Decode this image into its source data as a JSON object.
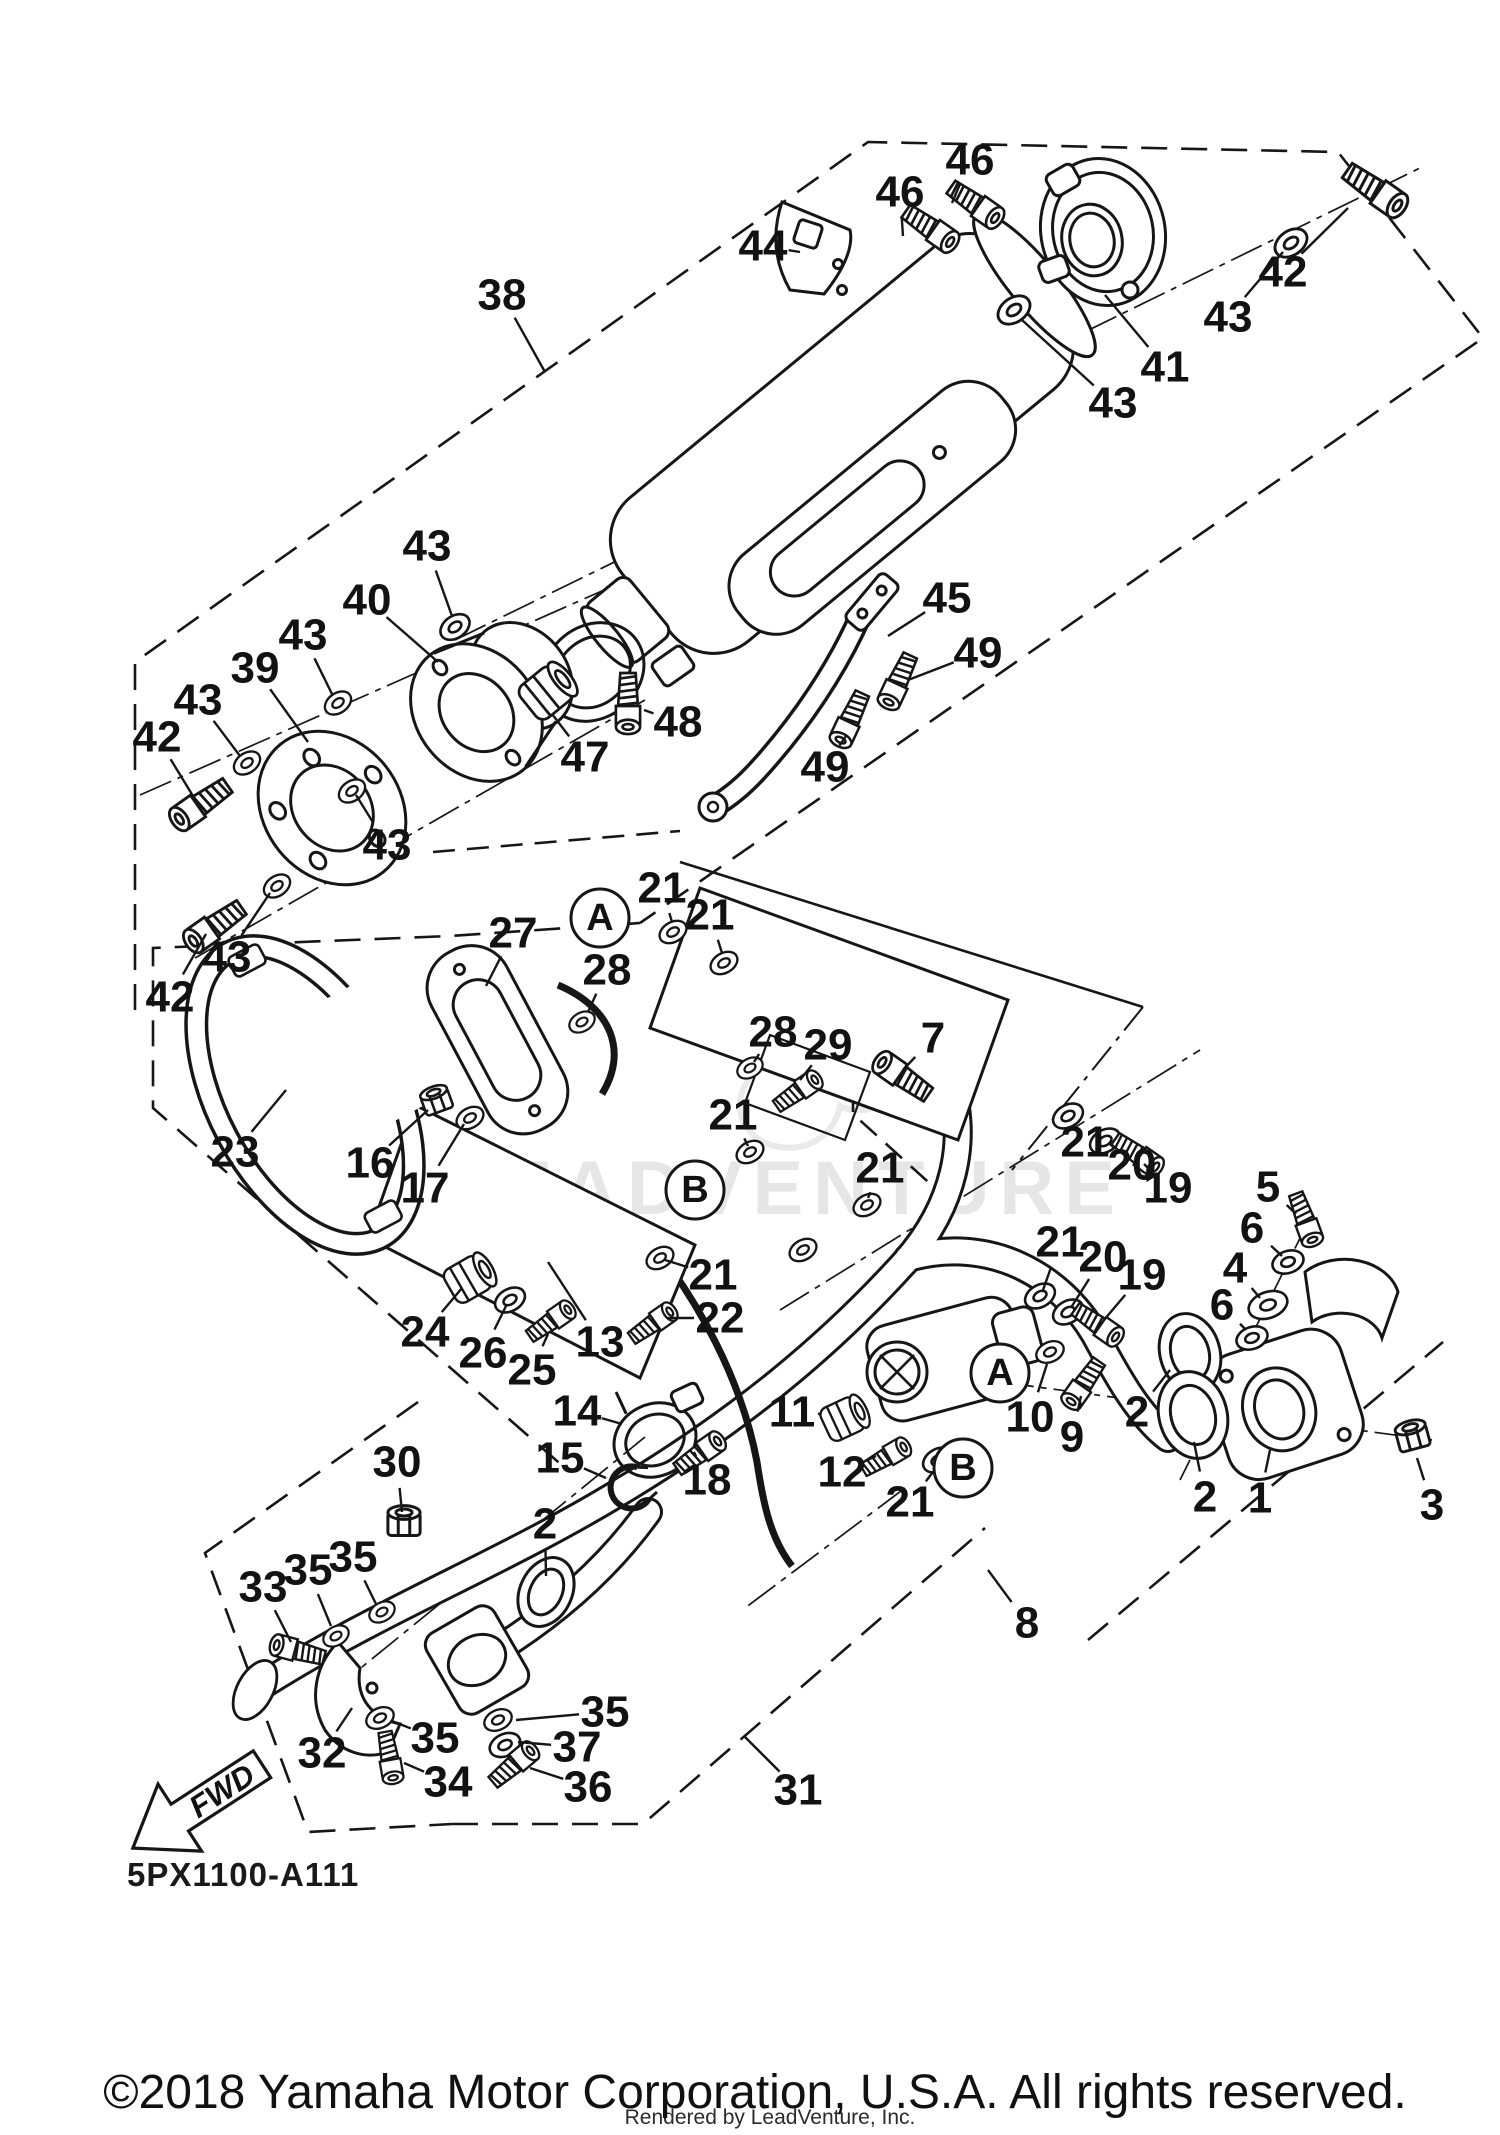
{
  "diagram": {
    "code": "5PX1100-A111",
    "watermark": "LEADVENTURE",
    "fwd_label": "FWD",
    "connectors": [
      {
        "label": "A",
        "x": 600,
        "y": 918
      },
      {
        "label": "B",
        "x": 695,
        "y": 1190
      },
      {
        "label": "A",
        "x": 1000,
        "y": 1373
      },
      {
        "label": "B",
        "x": 963,
        "y": 1468
      }
    ],
    "callouts": [
      {
        "label": "46",
        "x": 970,
        "y": 160,
        "lx": 952,
        "ly": 203
      },
      {
        "label": "46",
        "x": 900,
        "y": 192,
        "lx": 903,
        "ly": 236
      },
      {
        "label": "44",
        "x": 763,
        "y": 246,
        "lx": 800,
        "ly": 252
      },
      {
        "label": "38",
        "x": 502,
        "y": 295,
        "lx": 545,
        "ly": 372
      },
      {
        "label": "42",
        "x": 1283,
        "y": 272,
        "lx": 1348,
        "ly": 208
      },
      {
        "label": "43",
        "x": 1228,
        "y": 317,
        "lx": 1283,
        "ly": 252
      },
      {
        "label": "41",
        "x": 1165,
        "y": 367,
        "lx": 1105,
        "ly": 295
      },
      {
        "label": "43",
        "x": 1113,
        "y": 403,
        "lx": 1022,
        "ly": 320
      },
      {
        "label": "43",
        "x": 427,
        "y": 546,
        "lx": 452,
        "ly": 616
      },
      {
        "label": "40",
        "x": 367,
        "y": 600,
        "lx": 438,
        "ly": 662
      },
      {
        "label": "43",
        "x": 303,
        "y": 635,
        "lx": 332,
        "ly": 694
      },
      {
        "label": "39",
        "x": 255,
        "y": 668,
        "lx": 308,
        "ly": 742
      },
      {
        "label": "43",
        "x": 198,
        "y": 700,
        "lx": 240,
        "ly": 756
      },
      {
        "label": "42",
        "x": 157,
        "y": 737,
        "lx": 193,
        "ly": 796
      },
      {
        "label": "43",
        "x": 387,
        "y": 845,
        "lx": 356,
        "ly": 795
      },
      {
        "label": "43",
        "x": 227,
        "y": 957,
        "lx": 270,
        "ly": 893
      },
      {
        "label": "42",
        "x": 170,
        "y": 997,
        "lx": 206,
        "ly": 934
      },
      {
        "label": "45",
        "x": 947,
        "y": 598,
        "lx": 888,
        "ly": 636
      },
      {
        "label": "49",
        "x": 978,
        "y": 653,
        "lx": 908,
        "ly": 680
      },
      {
        "label": "48",
        "x": 678,
        "y": 722,
        "lx": 644,
        "ly": 710
      },
      {
        "label": "47",
        "x": 585,
        "y": 757,
        "lx": 552,
        "ly": 714
      },
      {
        "label": "49",
        "x": 825,
        "y": 767,
        "lx": 846,
        "ly": 736
      },
      {
        "label": "27",
        "x": 513,
        "y": 933,
        "lx": 486,
        "ly": 986
      },
      {
        "label": "21",
        "x": 662,
        "y": 888,
        "lx": 672,
        "ly": 922
      },
      {
        "label": "21",
        "x": 710,
        "y": 915,
        "lx": 722,
        "ly": 953
      },
      {
        "label": "28",
        "x": 607,
        "y": 970,
        "lx": 588,
        "ly": 1012
      },
      {
        "label": "28",
        "x": 773,
        "y": 1032,
        "lx": 754,
        "ly": 1062
      },
      {
        "label": "29",
        "x": 828,
        "y": 1045,
        "lx": 800,
        "ly": 1080
      },
      {
        "label": "7",
        "x": 933,
        "y": 1038,
        "lx": 903,
        "ly": 1070
      },
      {
        "label": "23",
        "x": 235,
        "y": 1152,
        "lx": 286,
        "ly": 1090
      },
      {
        "label": "16",
        "x": 370,
        "y": 1163,
        "lx": 428,
        "ly": 1110
      },
      {
        "label": "17",
        "x": 425,
        "y": 1188,
        "lx": 464,
        "ly": 1124
      },
      {
        "label": "21",
        "x": 733,
        "y": 1115,
        "lx": 748,
        "ly": 1146
      },
      {
        "label": "21",
        "x": 880,
        "y": 1168,
        "lx": 868,
        "ly": 1198
      },
      {
        "label": "13",
        "x": 600,
        "y": 1342,
        "lx": 548,
        "ly": 1262
      },
      {
        "label": "21",
        "x": 713,
        "y": 1275,
        "lx": 665,
        "ly": 1260
      },
      {
        "label": "22",
        "x": 720,
        "y": 1318,
        "lx": 668,
        "ly": 1318
      },
      {
        "label": "24",
        "x": 425,
        "y": 1332,
        "lx": 462,
        "ly": 1288
      },
      {
        "label": "26",
        "x": 483,
        "y": 1353,
        "lx": 506,
        "ly": 1306
      },
      {
        "label": "25",
        "x": 532,
        "y": 1370,
        "lx": 548,
        "ly": 1334
      },
      {
        "label": "14",
        "x": 577,
        "y": 1411,
        "lx": 622,
        "ly": 1424
      },
      {
        "label": "15",
        "x": 560,
        "y": 1458,
        "lx": 606,
        "ly": 1478
      },
      {
        "label": "18",
        "x": 707,
        "y": 1480,
        "lx": 694,
        "ly": 1452
      },
      {
        "label": "11",
        "x": 792,
        "y": 1412,
        "lx": 820,
        "ly": 1414
      },
      {
        "label": "12",
        "x": 842,
        "y": 1472,
        "lx": 876,
        "ly": 1456
      },
      {
        "label": "21",
        "x": 910,
        "y": 1502,
        "lx": 933,
        "ly": 1472
      },
      {
        "label": "10",
        "x": 1030,
        "y": 1417,
        "lx": 1047,
        "ly": 1364
      },
      {
        "label": "9",
        "x": 1072,
        "y": 1437,
        "lx": 1081,
        "ly": 1396
      },
      {
        "label": "2",
        "x": 1137,
        "y": 1412,
        "lx": 1170,
        "ly": 1370
      },
      {
        "label": "5",
        "x": 1268,
        "y": 1187,
        "lx": 1296,
        "ly": 1214
      },
      {
        "label": "6",
        "x": 1252,
        "y": 1228,
        "lx": 1282,
        "ly": 1256
      },
      {
        "label": "4",
        "x": 1235,
        "y": 1268,
        "lx": 1260,
        "ly": 1298
      },
      {
        "label": "6",
        "x": 1222,
        "y": 1305,
        "lx": 1246,
        "ly": 1330
      },
      {
        "label": "21",
        "x": 1085,
        "y": 1142,
        "lx": 1071,
        "ly": 1121
      },
      {
        "label": "20",
        "x": 1132,
        "y": 1165,
        "lx": 1110,
        "ly": 1144
      },
      {
        "label": "19",
        "x": 1168,
        "y": 1188,
        "lx": 1144,
        "ly": 1164
      },
      {
        "label": "21",
        "x": 1060,
        "y": 1242,
        "lx": 1043,
        "ly": 1290
      },
      {
        "label": "20",
        "x": 1103,
        "y": 1257,
        "lx": 1072,
        "ly": 1306
      },
      {
        "label": "19",
        "x": 1142,
        "y": 1275,
        "lx": 1104,
        "ly": 1320
      },
      {
        "label": "2",
        "x": 1205,
        "y": 1497,
        "lx": 1194,
        "ly": 1442
      },
      {
        "label": "1",
        "x": 1260,
        "y": 1498,
        "lx": 1270,
        "ly": 1450
      },
      {
        "label": "3",
        "x": 1432,
        "y": 1505,
        "lx": 1417,
        "ly": 1458
      },
      {
        "label": "8",
        "x": 1027,
        "y": 1623,
        "lx": 988,
        "ly": 1570
      },
      {
        "label": "30",
        "x": 397,
        "y": 1462,
        "lx": 402,
        "ly": 1512
      },
      {
        "label": "2",
        "x": 545,
        "y": 1524,
        "lx": 546,
        "ly": 1576
      },
      {
        "label": "35",
        "x": 353,
        "y": 1557,
        "lx": 376,
        "ly": 1604
      },
      {
        "label": "35",
        "x": 308,
        "y": 1570,
        "lx": 331,
        "ly": 1626
      },
      {
        "label": "33",
        "x": 263,
        "y": 1587,
        "lx": 291,
        "ly": 1642
      },
      {
        "label": "32",
        "x": 322,
        "y": 1753,
        "lx": 352,
        "ly": 1708
      },
      {
        "label": "35",
        "x": 435,
        "y": 1738,
        "lx": 392,
        "ly": 1721
      },
      {
        "label": "34",
        "x": 448,
        "y": 1782,
        "lx": 404,
        "ly": 1763
      },
      {
        "label": "35",
        "x": 605,
        "y": 1712,
        "lx": 516,
        "ly": 1720
      },
      {
        "label": "37",
        "x": 577,
        "y": 1747,
        "lx": 518,
        "ly": 1742
      },
      {
        "label": "36",
        "x": 588,
        "y": 1787,
        "lx": 530,
        "ly": 1768
      },
      {
        "label": "31",
        "x": 798,
        "y": 1790,
        "lx": 744,
        "ly": 1736
      }
    ]
  },
  "footer": {
    "copyright": "©2018 Yamaha Motor Corporation, U.S.A. All rights reserved.",
    "rendered_by": "Rendered by LeadVenture, Inc."
  }
}
